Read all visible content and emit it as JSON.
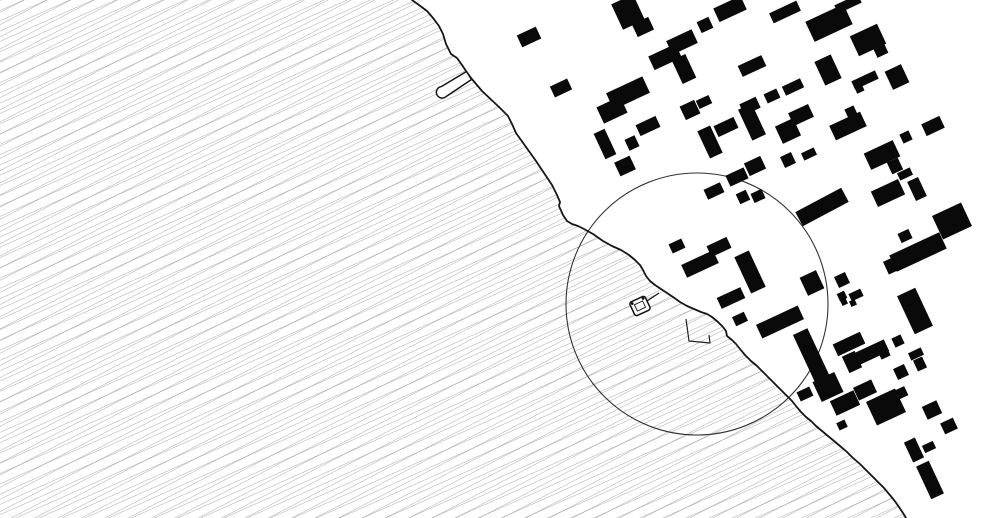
{
  "canvas": {
    "width": 1000,
    "height": 518,
    "background": "#ffffff",
    "land_color": "#ffffff"
  },
  "water": {
    "hatch_color": "#8c8c8c",
    "hatches": [
      {
        "angle": -24,
        "spacing": 9.4,
        "stroke_width": 0.75
      },
      {
        "angle": -27.5,
        "spacing": 10.8,
        "stroke_width": 0.7
      }
    ]
  },
  "shoreline": {
    "stroke": "#161616",
    "stroke_width": 1.8,
    "points": [
      [
        412,
        0
      ],
      [
        419,
        5
      ],
      [
        427,
        11
      ],
      [
        433,
        18
      ],
      [
        439,
        26
      ],
      [
        443,
        34
      ],
      [
        446,
        44
      ],
      [
        451,
        54
      ],
      [
        457,
        58
      ],
      [
        462,
        65
      ],
      [
        466,
        71
      ],
      [
        471,
        78
      ],
      [
        482,
        91
      ],
      [
        499,
        107
      ],
      [
        508,
        116
      ],
      [
        512,
        124
      ],
      [
        516,
        133
      ],
      [
        536,
        161
      ],
      [
        552,
        185
      ],
      [
        557,
        195
      ],
      [
        560,
        202
      ],
      [
        559,
        206
      ],
      [
        563,
        215
      ],
      [
        567,
        221
      ],
      [
        572,
        224
      ],
      [
        578,
        226
      ],
      [
        584,
        229
      ],
      [
        593,
        234
      ],
      [
        603,
        241
      ],
      [
        612,
        246
      ],
      [
        621,
        250
      ],
      [
        629,
        255
      ],
      [
        635,
        260
      ],
      [
        640,
        265
      ],
      [
        643,
        270
      ],
      [
        646,
        276
      ],
      [
        650,
        281
      ],
      [
        655,
        285
      ],
      [
        661,
        289
      ],
      [
        667,
        293
      ],
      [
        673,
        297
      ],
      [
        680,
        302
      ],
      [
        687,
        306
      ],
      [
        694,
        309
      ],
      [
        701,
        312
      ],
      [
        707,
        314
      ],
      [
        712,
        317
      ],
      [
        718,
        322
      ],
      [
        723,
        327
      ],
      [
        726,
        331
      ],
      [
        727,
        336
      ],
      [
        732,
        340
      ],
      [
        736,
        344
      ],
      [
        740,
        349
      ],
      [
        745,
        355
      ],
      [
        751,
        361
      ],
      [
        757,
        366
      ],
      [
        763,
        372
      ],
      [
        769,
        378
      ],
      [
        776,
        385
      ],
      [
        782,
        391
      ],
      [
        788,
        397
      ],
      [
        792,
        401
      ],
      [
        796,
        406
      ],
      [
        801,
        412
      ],
      [
        806,
        417
      ],
      [
        811,
        421
      ],
      [
        816,
        426
      ],
      [
        822,
        431
      ],
      [
        828,
        436
      ],
      [
        834,
        441
      ],
      [
        840,
        446
      ],
      [
        847,
        452
      ],
      [
        853,
        458
      ],
      [
        860,
        464
      ],
      [
        866,
        470
      ],
      [
        872,
        476
      ],
      [
        878,
        482
      ],
      [
        884,
        488
      ],
      [
        889,
        494
      ],
      [
        894,
        500
      ],
      [
        899,
        507
      ],
      [
        903,
        513
      ],
      [
        906,
        518
      ]
    ],
    "close_corners": [
      [
        0,
        518
      ],
      [
        0,
        0
      ]
    ]
  },
  "site_circle": {
    "cx": 697,
    "cy": 304,
    "r": 131,
    "stroke": "#333333",
    "stroke_width": 1.1
  },
  "jetty": {
    "path": "M 466.5,71.5 L 441.5,86.5 A 5.8,5.8 0 1 0 445.8,96.8 L 471.5,79.5 Z",
    "fill": "#ffffff",
    "stroke": "#161616",
    "stroke_width": 1.5
  },
  "l_dock": {
    "points": [
      [
        686,
        319
      ],
      [
        689,
        341
      ],
      [
        710,
        343
      ],
      [
        709,
        335
      ]
    ],
    "stroke": "#222222",
    "stroke_width": 1.2
  },
  "site_structure": {
    "cx": 640,
    "cy": 306,
    "rotation": -25,
    "outer": {
      "w": 17,
      "h": 15,
      "rx": 2.5,
      "stroke_width": 1.5
    },
    "inner": {
      "w": 9,
      "h": 7,
      "stroke_width": 0.9
    },
    "dots": {
      "r": 1.4,
      "positions": [
        [
          -6,
          -5.5
        ],
        [
          6,
          -5.5
        ]
      ]
    },
    "bridge": {
      "x1": 647,
      "y1": 301,
      "x2": 659,
      "y2": 293,
      "stroke_width": 1.2
    },
    "stroke": "#111111",
    "fill": "#ffffff"
  },
  "buildings": {
    "fill": "#0a0a0a",
    "default_rotation": -25,
    "rects": [
      [
        529,
        37,
        21,
        13
      ],
      [
        561,
        88,
        19,
        12
      ],
      [
        628,
        12,
        24,
        28
      ],
      [
        643,
        27,
        18,
        14
      ],
      [
        682,
        42,
        28,
        15
      ],
      [
        665,
        57,
        30,
        15
      ],
      [
        684,
        69,
        15,
        26
      ],
      [
        705,
        25,
        13,
        12
      ],
      [
        730,
        9,
        30,
        15
      ],
      [
        648,
        126,
        22,
        12
      ],
      [
        628,
        93,
        40,
        18
      ],
      [
        612,
        110,
        26,
        18
      ],
      [
        690,
        110,
        16,
        15
      ],
      [
        704,
        102,
        14,
        9
      ],
      [
        632,
        143,
        11,
        12
      ],
      [
        625,
        166,
        17,
        15
      ],
      [
        605,
        144,
        12,
        28
      ],
      [
        785,
        12,
        30,
        11
      ],
      [
        848,
        4,
        26,
        9
      ],
      [
        829,
        23,
        42,
        22
      ],
      [
        868,
        40,
        30,
        22
      ],
      [
        880,
        49,
        12,
        14
      ],
      [
        752,
        66,
        26,
        12
      ],
      [
        828,
        70,
        18,
        26
      ],
      [
        793,
        87,
        20,
        10
      ],
      [
        865,
        80,
        26,
        9
      ],
      [
        859,
        88,
        8,
        9
      ],
      [
        897,
        77,
        18,
        20
      ],
      [
        772,
        96,
        14,
        10
      ],
      [
        750,
        106,
        18,
        12
      ],
      [
        801,
        115,
        22,
        14
      ],
      [
        848,
        126,
        34,
        16
      ],
      [
        851,
        112,
        10,
        10
      ],
      [
        933,
        126,
        20,
        13
      ],
      [
        710,
        142,
        14,
        30
      ],
      [
        726,
        127,
        22,
        12
      ],
      [
        752,
        122,
        15,
        34
      ],
      [
        788,
        131,
        20,
        19
      ],
      [
        755,
        166,
        18,
        14
      ],
      [
        788,
        160,
        12,
        12
      ],
      [
        809,
        154,
        14,
        8
      ],
      [
        737,
        177,
        20,
        12
      ],
      [
        714,
        191,
        18,
        11
      ],
      [
        743,
        197,
        11,
        11
      ],
      [
        758,
        196,
        12,
        10
      ],
      [
        822,
        207,
        52,
        16,
        -28
      ],
      [
        882,
        155,
        32,
        18
      ],
      [
        895,
        166,
        12,
        13
      ],
      [
        906,
        137,
        10,
        10
      ],
      [
        888,
        193,
        30,
        17
      ],
      [
        917,
        189,
        12,
        21
      ],
      [
        905,
        174,
        14,
        8
      ],
      [
        952,
        221,
        32,
        26
      ],
      [
        918,
        252,
        55,
        18
      ],
      [
        895,
        264,
        20,
        14
      ],
      [
        905,
        236,
        12,
        10
      ],
      [
        700,
        264,
        35,
        14
      ],
      [
        719,
        247,
        22,
        12
      ],
      [
        677,
        246,
        14,
        10
      ],
      [
        750,
        272,
        16,
        40
      ],
      [
        731,
        298,
        26,
        12
      ],
      [
        740,
        319,
        13,
        10
      ],
      [
        780,
        322,
        46,
        15
      ],
      [
        812,
        357,
        16,
        56
      ],
      [
        812,
        283,
        18,
        20
      ],
      [
        842,
        280,
        12,
        12
      ],
      [
        842,
        296,
        8,
        8
      ],
      [
        844,
        302,
        6,
        6
      ],
      [
        853,
        303,
        6,
        6
      ],
      [
        856,
        295,
        13,
        8
      ],
      [
        849,
        344,
        30,
        13
      ],
      [
        852,
        362,
        14,
        18
      ],
      [
        872,
        352,
        32,
        13
      ],
      [
        828,
        387,
        24,
        22
      ],
      [
        805,
        394,
        14,
        10
      ],
      [
        865,
        390,
        20,
        14
      ],
      [
        915,
        311,
        20,
        42
      ],
      [
        898,
        341,
        10,
        10
      ],
      [
        884,
        353,
        10,
        10
      ],
      [
        916,
        354,
        14,
        8
      ],
      [
        920,
        364,
        10,
        12
      ],
      [
        901,
        372,
        12,
        12
      ],
      [
        886,
        407,
        32,
        26
      ],
      [
        899,
        394,
        16,
        10
      ],
      [
        845,
        403,
        26,
        16
      ],
      [
        842,
        425,
        9,
        8
      ],
      [
        932,
        410,
        16,
        14
      ],
      [
        949,
        426,
        14,
        12
      ],
      [
        914,
        450,
        12,
        22
      ],
      [
        929,
        447,
        12,
        8
      ],
      [
        930,
        480,
        14,
        36
      ]
    ]
  }
}
